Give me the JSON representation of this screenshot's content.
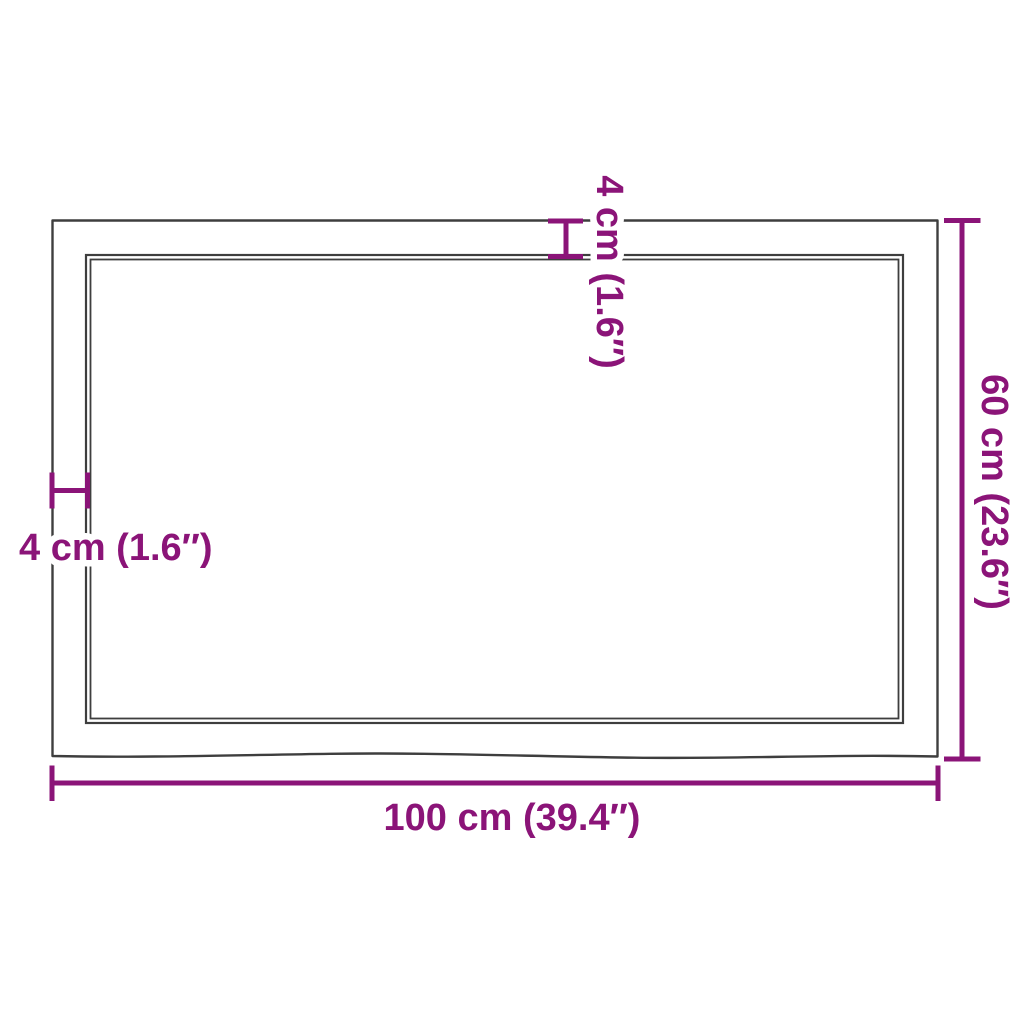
{
  "diagram": {
    "type": "product-dimension-diagram",
    "subject": "tabletop-top-view-with-live-edge",
    "labels": {
      "width": "100 cm (39.4″)",
      "height": "60 cm (23.6″)",
      "thickness_top": "4 cm (1.6″)",
      "thickness_left": "4 cm (1.6″)"
    },
    "dimensions": {
      "width_cm": 100,
      "width_in": 39.4,
      "height_cm": 60,
      "height_in": 23.6,
      "thickness_cm": 4,
      "thickness_in": 1.6
    },
    "colors": {
      "dimension_accent": "#8B1478",
      "outline": "#3E3E3E",
      "background": "#FFFFFF"
    }
  }
}
